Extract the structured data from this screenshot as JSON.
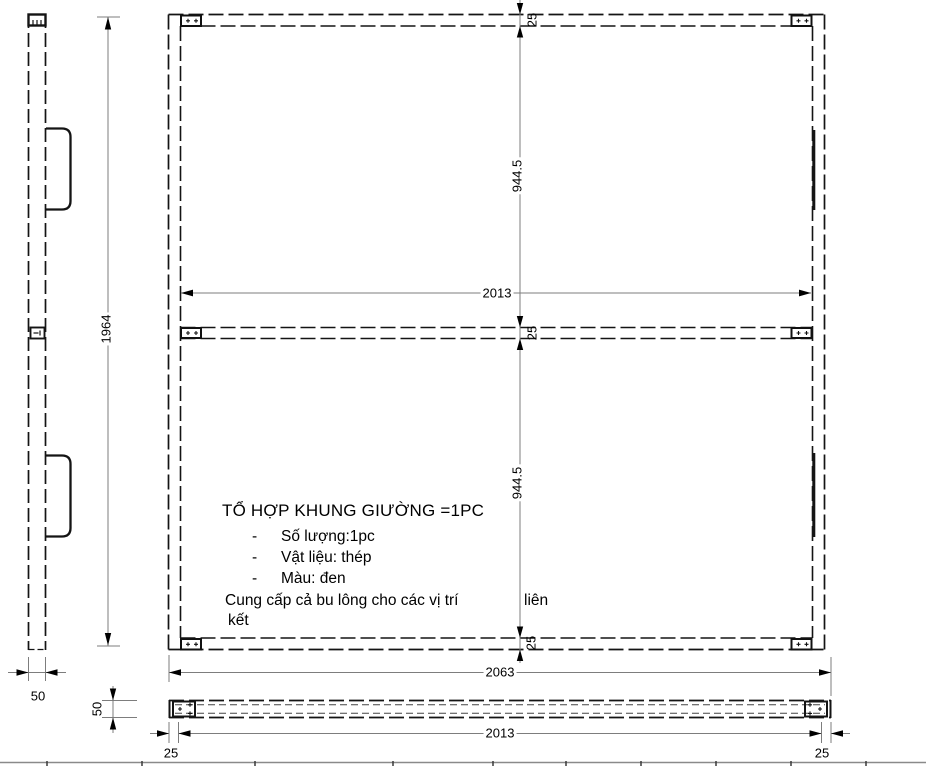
{
  "drawing": {
    "notes": {
      "title": "TỔ HỢP KHUNG GIƯỜNG =1PC",
      "dash": "-",
      "items": [
        "Số lượng:1pc",
        "Vật liệu: thép",
        "Màu: đen"
      ],
      "note_main": "Cung cấp cả bu lông cho các vị trí",
      "note_tail": "liên",
      "note_wrap": "kết"
    },
    "dims": {
      "overall_height": "1964",
      "side_width": "50",
      "profile_height": "50",
      "rail_top": "25",
      "rail_mid": "25",
      "rail_bottom": "25",
      "bay_upper": "944.5",
      "bay_lower": "944.5",
      "inner_width": "2013",
      "overall_width": "2063",
      "front_inner_width": "2013",
      "end_left": "25",
      "end_right": "25"
    }
  }
}
